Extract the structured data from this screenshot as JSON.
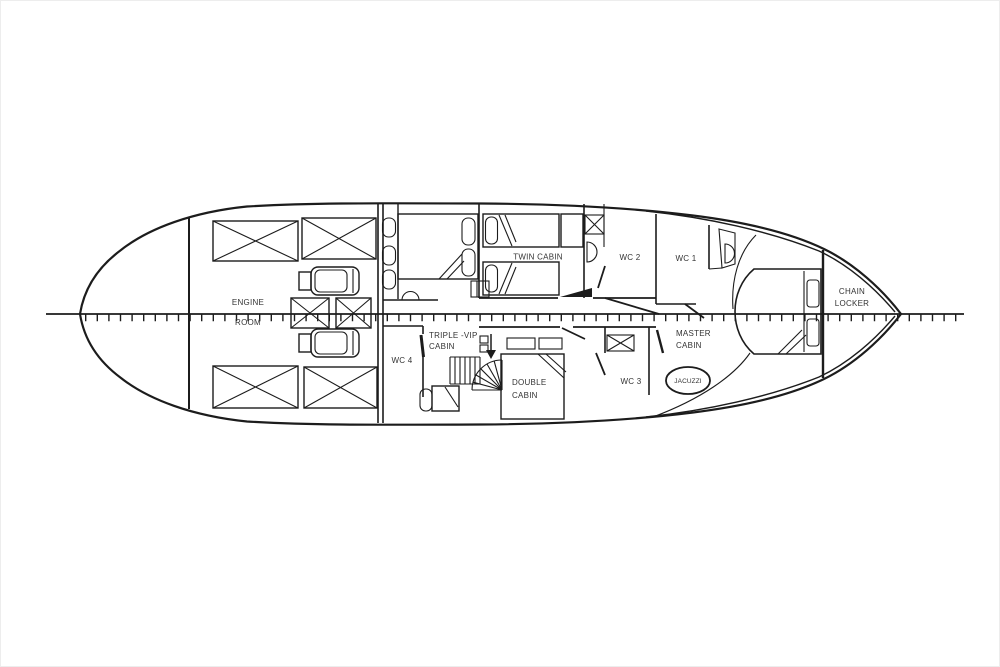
{
  "diagram": {
    "kind": "yacht lower-deck floor plan, profile ticks along centerline",
    "background_color": "#ffffff",
    "line_color": "#1c1c1c",
    "text_color": "#333333"
  },
  "rooms": {
    "engine_room": {
      "line1": "ENGINE",
      "line2": "ROOM"
    },
    "twin_cabin": {
      "line1": "TWIN CABIN"
    },
    "wc2": {
      "line1": "WC 2"
    },
    "wc1": {
      "line1": "WC 1"
    },
    "chain_locker": {
      "line1": "CHAIN",
      "line2": "LOCKER"
    },
    "triple_vip_cabin": {
      "line1": "TRIPLE -VIP",
      "line2": "CABIN"
    },
    "wc4": {
      "line1": "WC 4"
    },
    "double_cabin": {
      "line1": "DOUBLE",
      "line2": "CABIN"
    },
    "wc3": {
      "line1": "WC 3"
    },
    "master_cabin": {
      "line1": "MASTER",
      "line2": "CABIN"
    },
    "jacuzzi": {
      "line1": "JACUZZI"
    }
  }
}
